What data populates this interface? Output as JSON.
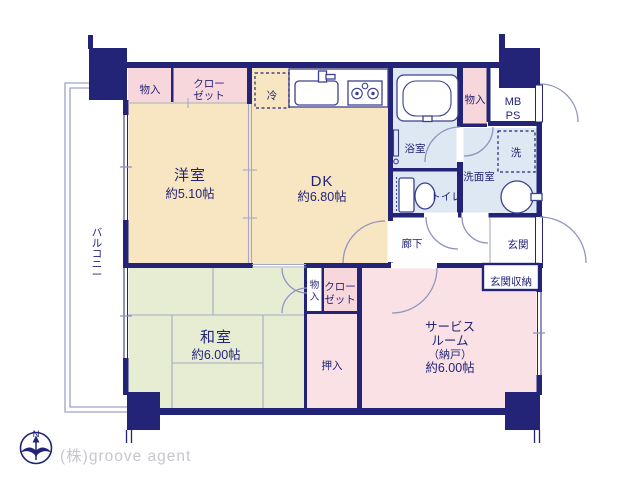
{
  "plan": {
    "rooms": {
      "yoshitsu": {
        "label": "洋室",
        "size": "約5.10帖"
      },
      "dk": {
        "label": "DK",
        "size": "約6.80帖"
      },
      "washitsu": {
        "label": "和室",
        "size": "約6.00帖"
      },
      "service": {
        "line1": "サービス",
        "line2": "ルーム",
        "line3": "（納戸）",
        "line4": "約6.00帖"
      },
      "balcony": {
        "label": "バルコニー"
      },
      "bath": {
        "label": "浴室"
      },
      "toilet": {
        "label": "トイレ"
      },
      "washroom": {
        "label": "洗面室"
      },
      "hall": {
        "label": "廊下"
      },
      "entrance": {
        "label": "玄関"
      },
      "entrance_storage": {
        "label": "玄関収納"
      },
      "mbps": {
        "line1": "MB",
        "line2": "PS"
      }
    },
    "storage": {
      "monoire_top": {
        "label": "物入"
      },
      "closet_top": {
        "line1": "クロー",
        "line2": "ゼット"
      },
      "monoire_bath": {
        "label": "物入"
      },
      "monoire_mid": {
        "label": "物入"
      },
      "closet_mid": {
        "line1": "クロー",
        "line2": "ゼット"
      },
      "oshiire": {
        "label": "押入"
      }
    },
    "fixtures": {
      "fridge": "冷",
      "washer": "洗"
    },
    "compass": {
      "north": "N"
    },
    "footer": {
      "brand": "(株)groove agent"
    },
    "colors": {
      "wall_navy": "#232478",
      "room_cream": "#f8e6c2",
      "room_green": "#e7edd3",
      "room_pink": "#fae1e5",
      "closet_pink": "#f8d7dc",
      "wet_blue": "#dde8f3",
      "line_gray": "#9ca3c8",
      "brand_gray": "#c6c7cf"
    }
  }
}
